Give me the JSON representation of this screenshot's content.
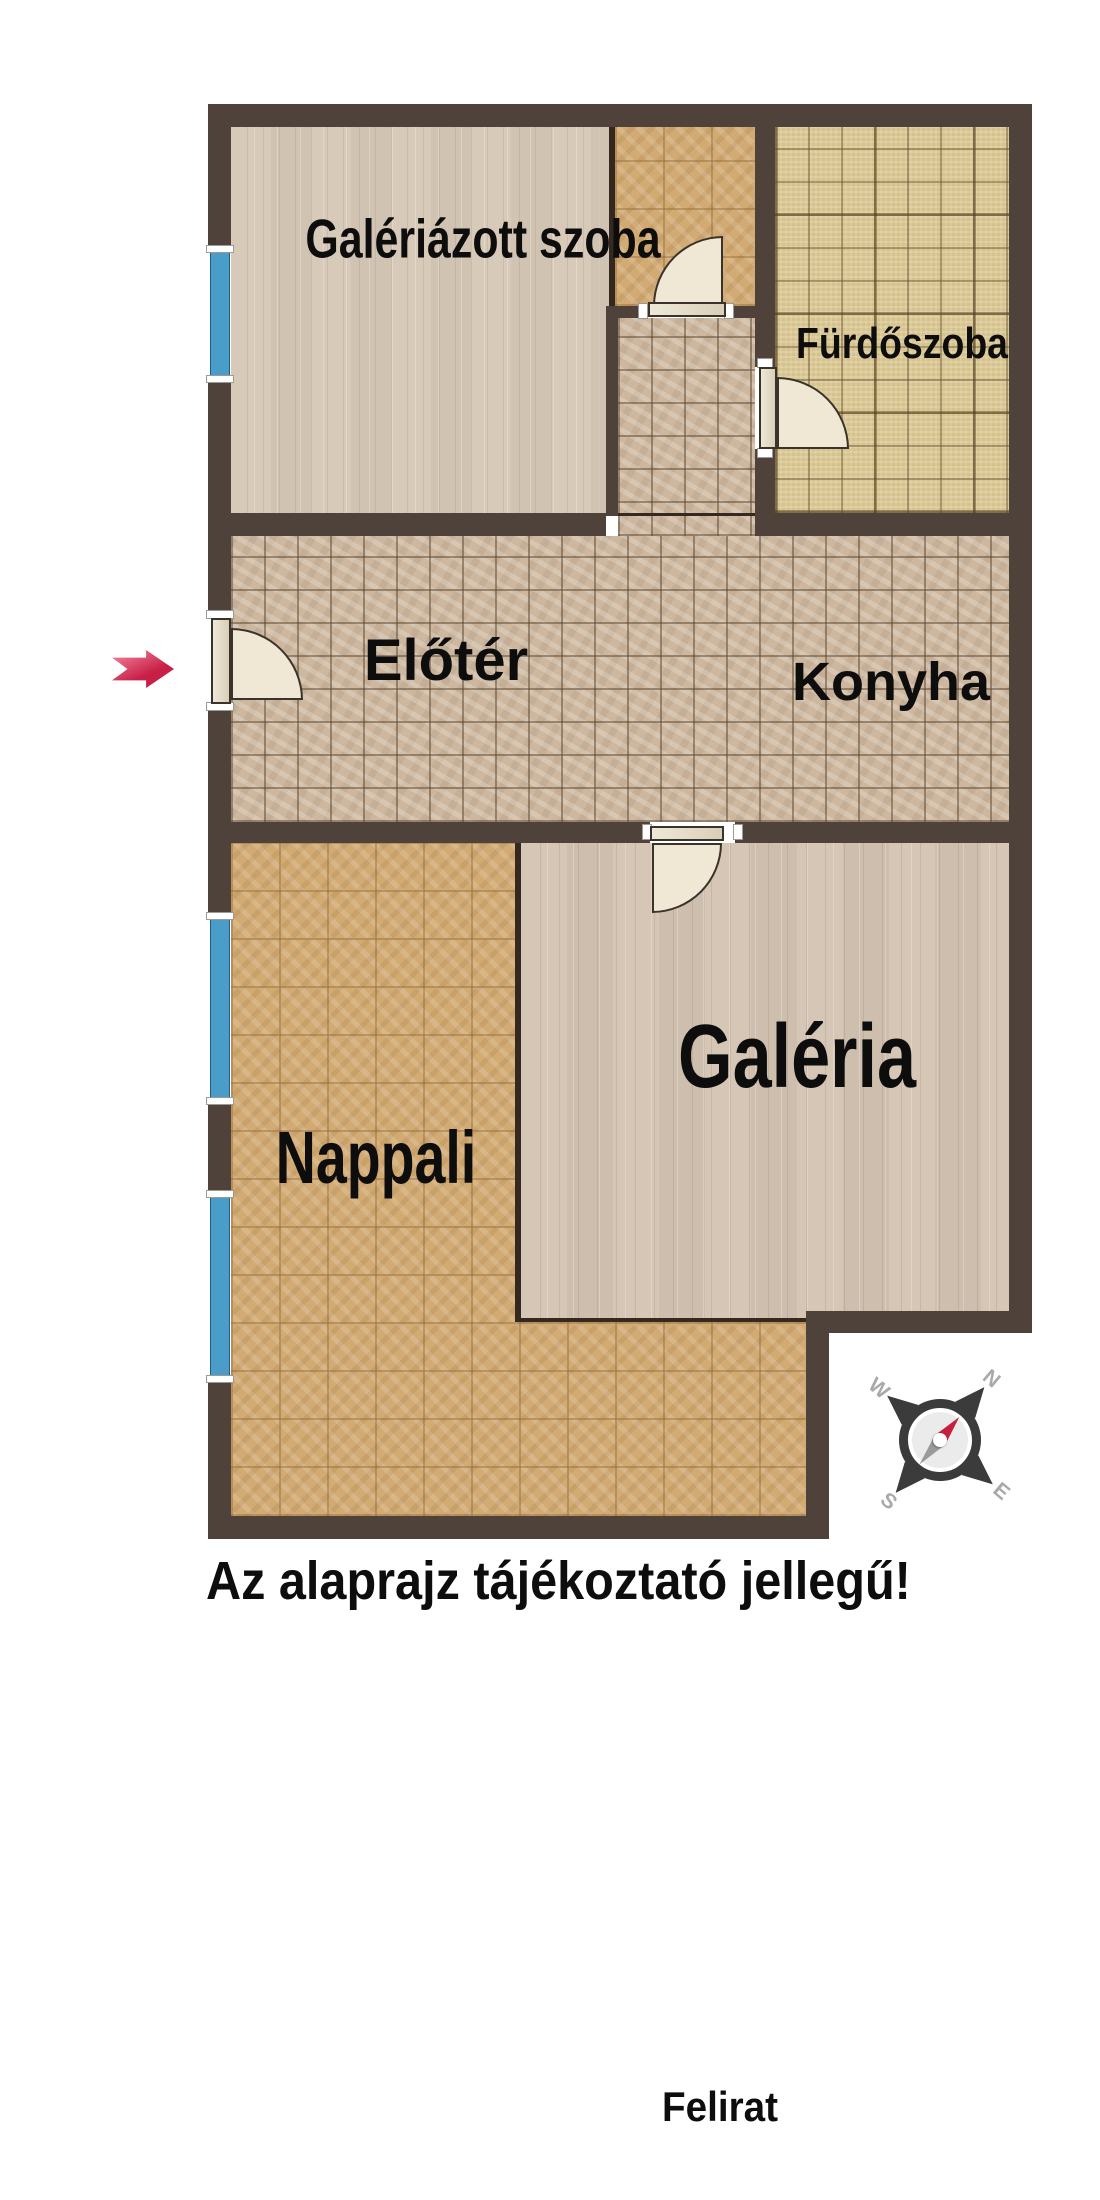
{
  "rooms": {
    "galeriazott": {
      "label": "Galériázott szoba"
    },
    "furdoszoba": {
      "label": "Fürdőszoba"
    },
    "eloter": {
      "label": "Előtér"
    },
    "konyha": {
      "label": "Konyha"
    },
    "nappali": {
      "label": "Nappali"
    },
    "galeria": {
      "label": "Galéria"
    }
  },
  "caption": "Az alaprajz tájékoztató jellegű!",
  "footer_caption": "Felirat",
  "compass": {
    "n": "N",
    "e": "E",
    "s": "S",
    "w": "W"
  },
  "colors": {
    "wall": "#4e423a",
    "wall-thin": "#33291f",
    "plank-floor": "#d8cab8",
    "parquet-floor": "#d2ab74",
    "tile-floor": "#cdb89f",
    "bath-floor": "#d6c28c",
    "window-blue": "#4a9dc9",
    "door-sweep": "#f0e8d5",
    "arrow-red": "#c81f47",
    "arrow-red-light": "#ef7b92",
    "compass-dark": "#3b3b3b",
    "compass-letter": "#a9a9a9",
    "needle-red": "#c81f3f",
    "needle-grey": "#9a9a9a",
    "label-text": "#0d0d0d"
  }
}
